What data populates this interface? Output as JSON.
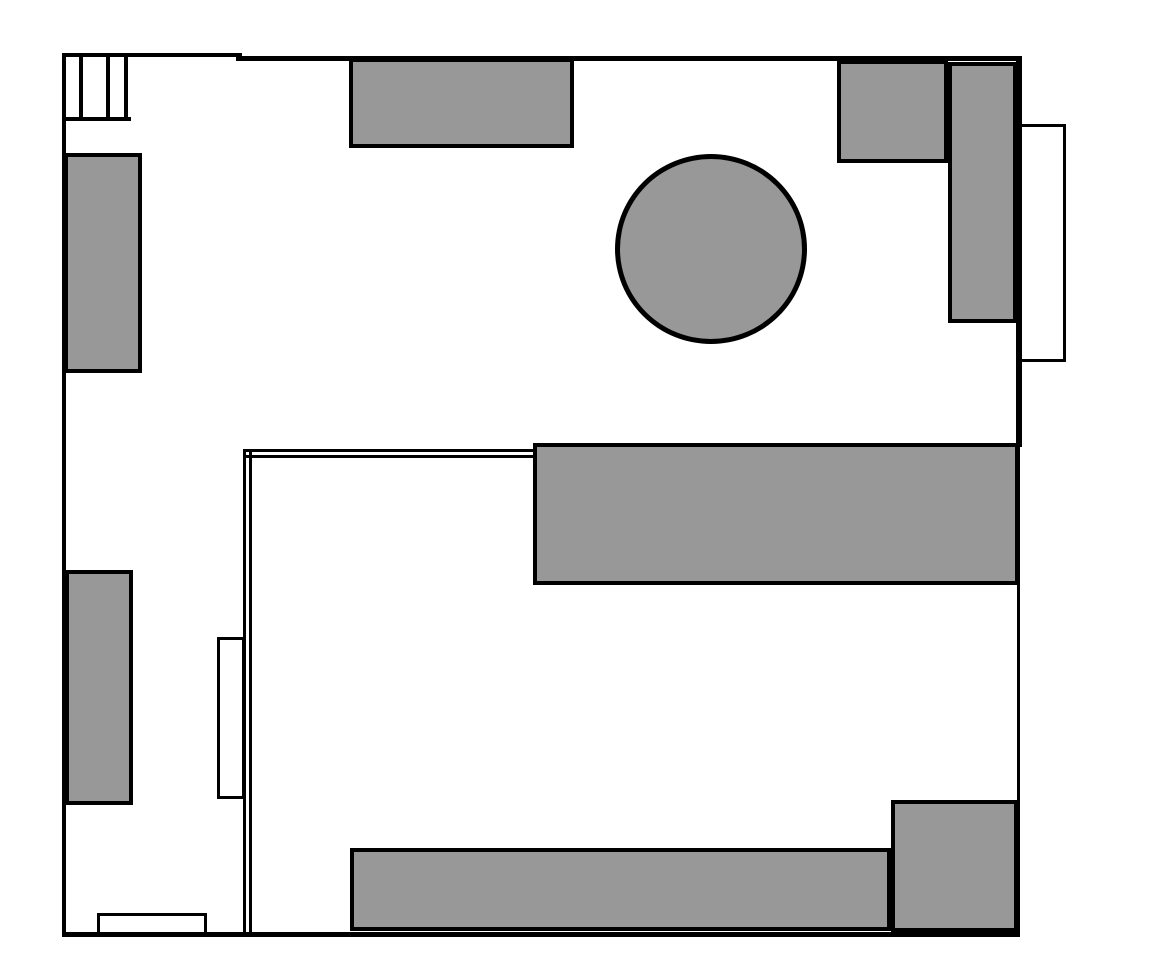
{
  "canvas": {
    "width": 1149,
    "height": 960,
    "background": "#ffffff",
    "line_color": "#000000",
    "furniture_fill": "#989898",
    "furniture_border": "#000000",
    "furniture_border_width": 4,
    "circle_border_width": 5,
    "opening_fill": "#ffffff",
    "opening_border": "#000000",
    "opening_border_width": 3
  },
  "shapes": [
    {
      "name": "wall-top-left-segment",
      "type": "wall",
      "x": 62,
      "y": 53,
      "w": 180,
      "h": 4
    },
    {
      "name": "wall-top-main-segment",
      "type": "wall",
      "x": 236,
      "y": 56,
      "w": 786,
      "h": 5
    },
    {
      "name": "wall-left",
      "type": "wall",
      "x": 62,
      "y": 53,
      "w": 4,
      "h": 884
    },
    {
      "name": "wall-bottom",
      "type": "wall",
      "x": 62,
      "y": 932,
      "w": 958,
      "h": 5
    },
    {
      "name": "wall-right-upper",
      "type": "wall",
      "x": 1016,
      "y": 56,
      "w": 6,
      "h": 391
    },
    {
      "name": "wall-right-lower",
      "type": "wall",
      "x": 1017,
      "y": 447,
      "w": 3,
      "h": 490
    },
    {
      "name": "partition-horizontal-outer-line",
      "type": "wall",
      "x": 243,
      "y": 449,
      "w": 290,
      "h": 3
    },
    {
      "name": "partition-horizontal-inner-line",
      "type": "wall",
      "x": 243,
      "y": 455,
      "w": 290,
      "h": 3
    },
    {
      "name": "partition-vertical-outer-line",
      "type": "wall",
      "x": 243,
      "y": 449,
      "w": 3,
      "h": 486
    },
    {
      "name": "partition-vertical-inner-line",
      "type": "wall",
      "x": 249,
      "y": 449,
      "w": 3,
      "h": 486
    },
    {
      "name": "window-mullion-1",
      "type": "wall",
      "x": 79,
      "y": 55,
      "w": 4,
      "h": 64
    },
    {
      "name": "window-mullion-2",
      "type": "wall",
      "x": 106,
      "y": 55,
      "w": 4,
      "h": 64
    },
    {
      "name": "window-mullion-3",
      "type": "wall",
      "x": 124,
      "y": 55,
      "w": 4,
      "h": 64
    },
    {
      "name": "window-sill",
      "type": "wall",
      "x": 66,
      "y": 117,
      "w": 65,
      "h": 4
    },
    {
      "name": "right-wall-door",
      "type": "opening",
      "x": 1019,
      "y": 124,
      "w": 47,
      "h": 238
    },
    {
      "name": "partition-door",
      "type": "opening",
      "x": 217,
      "y": 637,
      "w": 28,
      "h": 162
    },
    {
      "name": "bottom-wall-door",
      "type": "opening",
      "x": 97,
      "y": 913,
      "w": 110,
      "h": 22
    },
    {
      "name": "furniture-top-cabinet",
      "type": "furniture",
      "x": 349,
      "y": 58,
      "w": 225,
      "h": 90
    },
    {
      "name": "furniture-left-upper-cabinet",
      "type": "furniture",
      "x": 64,
      "y": 153,
      "w": 78,
      "h": 220
    },
    {
      "name": "furniture-round-table",
      "type": "furniture-circle",
      "x": 615,
      "y": 154,
      "w": 192,
      "h": 190
    },
    {
      "name": "furniture-corner-unit-top",
      "type": "furniture",
      "x": 837,
      "y": 60,
      "w": 111,
      "h": 103
    },
    {
      "name": "furniture-corner-unit-side",
      "type": "furniture",
      "x": 948,
      "y": 62,
      "w": 69,
      "h": 261
    },
    {
      "name": "furniture-center-counter",
      "type": "furniture",
      "x": 533,
      "y": 443,
      "w": 486,
      "h": 142
    },
    {
      "name": "furniture-left-lower-cabinet",
      "type": "furniture",
      "x": 65,
      "y": 570,
      "w": 68,
      "h": 235
    },
    {
      "name": "furniture-bottom-counter",
      "type": "furniture",
      "x": 350,
      "y": 848,
      "w": 541,
      "h": 83
    },
    {
      "name": "furniture-bottom-right-unit",
      "type": "furniture",
      "x": 891,
      "y": 800,
      "w": 127,
      "h": 132
    }
  ]
}
